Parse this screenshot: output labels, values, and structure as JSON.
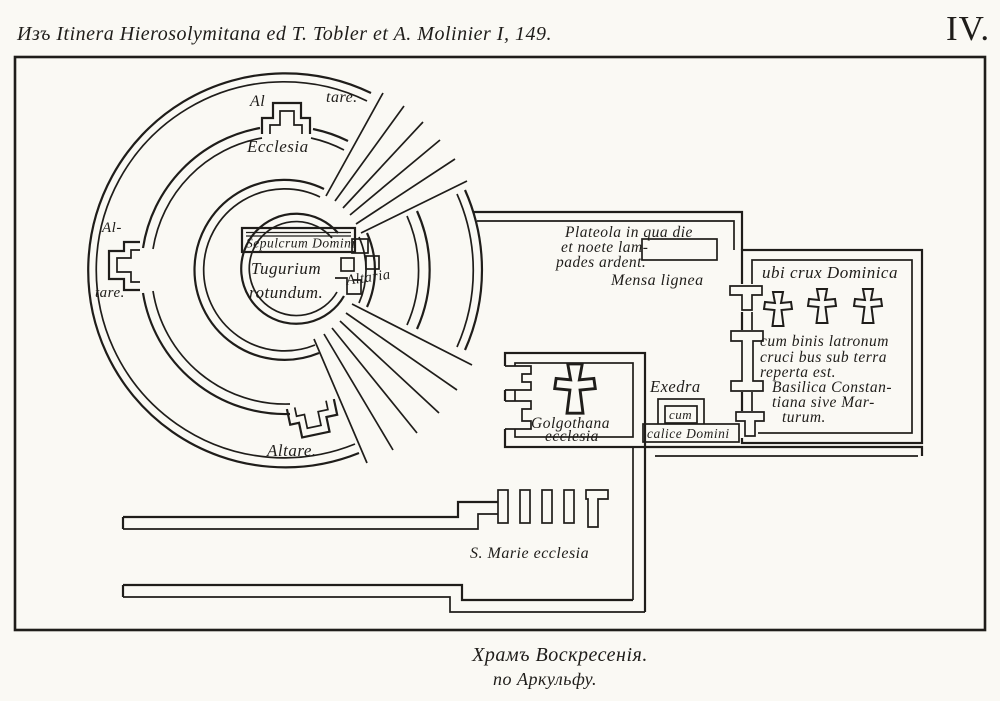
{
  "colors": {
    "ink": "#1f1d1a",
    "paper": "#faf9f4"
  },
  "header": {
    "citation": "Изъ Itinera Hierosolymitana ed T. Tobler et A. Molinier I, 149.",
    "plate_number": "IV."
  },
  "rotunda": {
    "altare_top_left": "Al",
    "altare_top_right": "tare.",
    "ecclesia": "Ecclesia",
    "altare_left_top": "Al-",
    "altare_left_bottom": "tare.",
    "altare_bottom": "Altare.",
    "sepulcrum": "Sepulcrum Domini",
    "tugurium_line1": "Tugurium",
    "tugurium_line2": "rotundum.",
    "altaria": "Altaria"
  },
  "courtyard": {
    "plateola_line1": "Plateola in qua die",
    "plateola_line2": "et noete lam-",
    "plateola_line3": "pades ardent.",
    "mensa_label": "Mensa lignea"
  },
  "basilica": {
    "title": "ubi crux Dominica",
    "line1": "cum binis latronum",
    "line2": "cruci bus sub terra",
    "line3": "reperta est.",
    "line4": "Basilica Constan-",
    "line5": "tiana sive Mar-",
    "line6": "turum.",
    "cross_icons": [
      "cross-of-dominica",
      "cross-of-latro-1",
      "cross-of-latro-2"
    ]
  },
  "exedra": {
    "label": "Exedra",
    "cum": "cum",
    "calice": "calice Domini"
  },
  "golgotha": {
    "line1": "Golgothana",
    "line2": "ecclesia"
  },
  "smarie": {
    "label": "S. Marie ecclesia"
  },
  "caption": {
    "line1": "Храмъ Воскресенія.",
    "line2": "по Аркульфу."
  }
}
